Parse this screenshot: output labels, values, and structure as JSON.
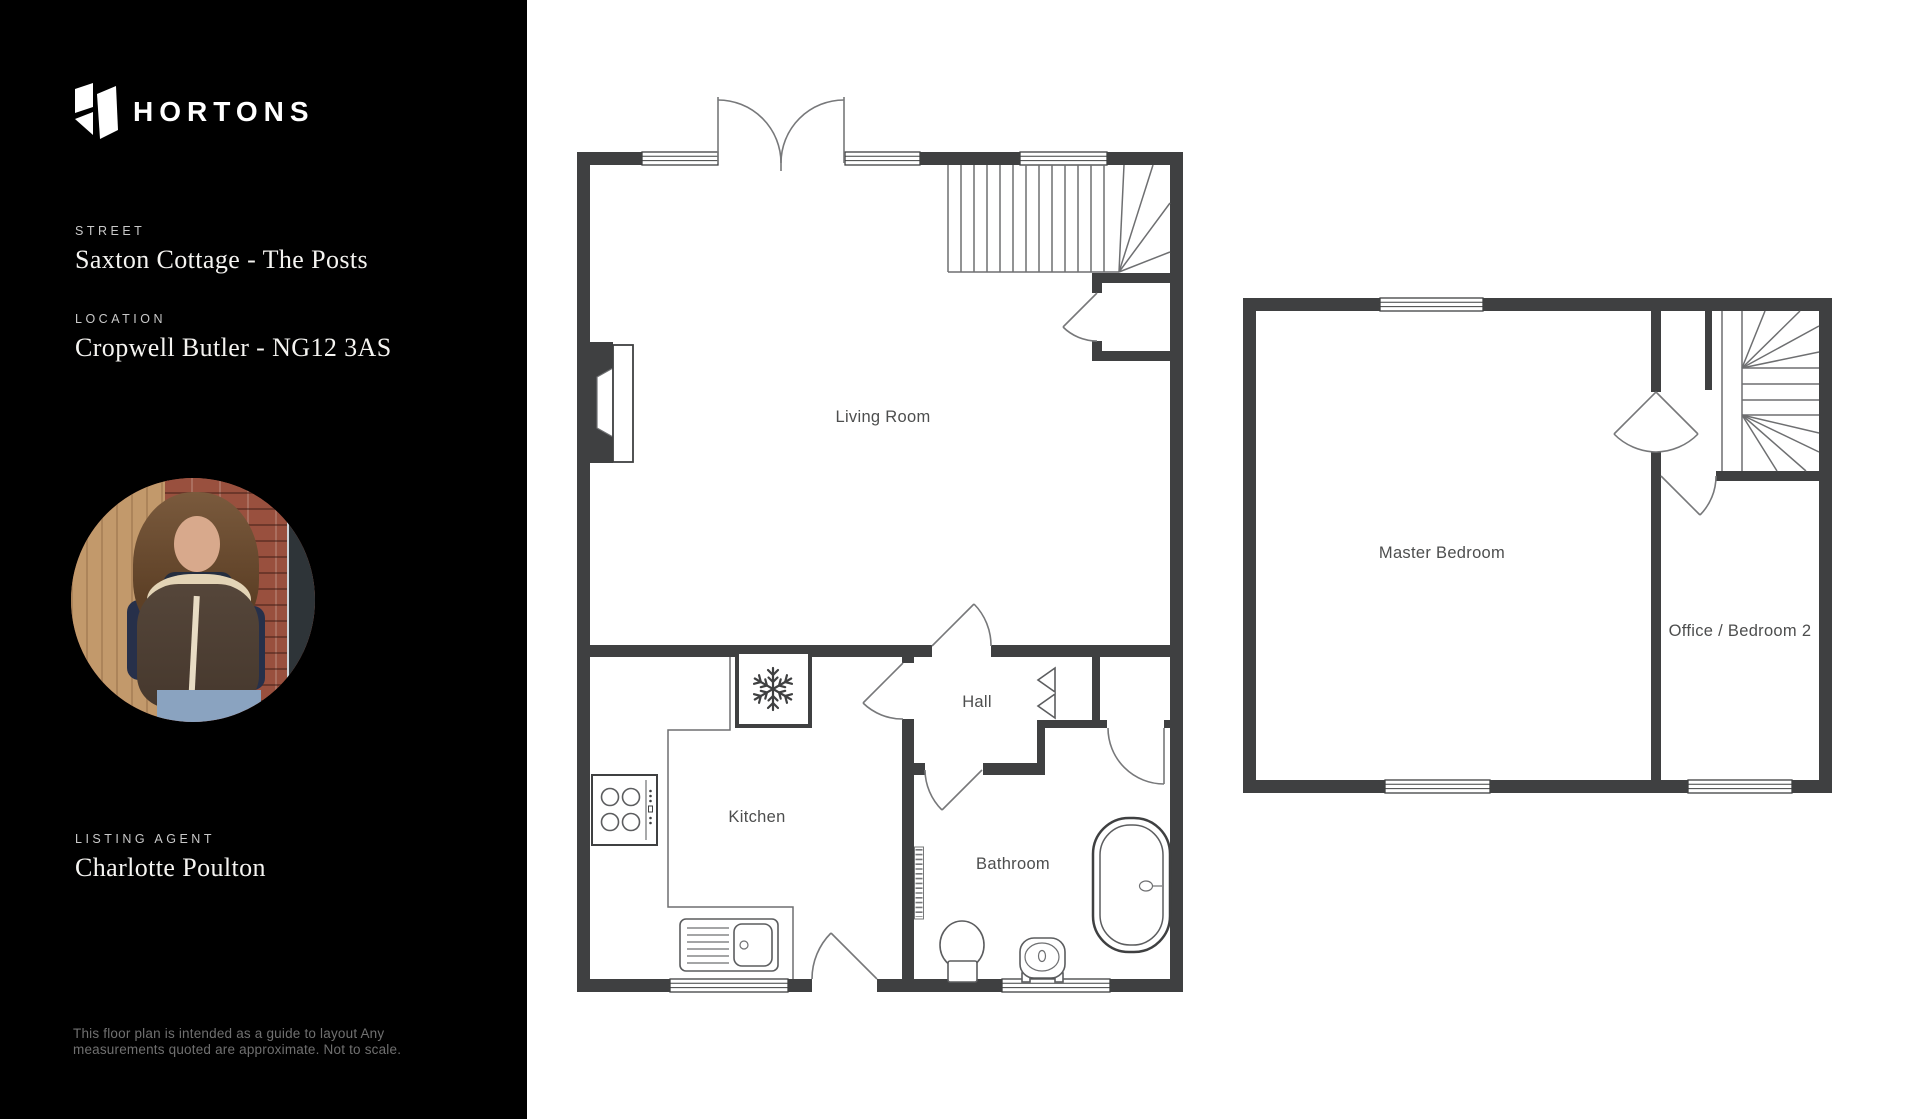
{
  "colors": {
    "sidebar_bg": "#000000",
    "wall": "#3f4041",
    "thin_line": "#6e6f71",
    "room_label": "#4d4e4e",
    "sidebar_heading": "#c9c9c9",
    "sidebar_text": "#f5f4f1",
    "disclaimer_text": "#707070"
  },
  "sidebar": {
    "brand": "HORTONS",
    "street": {
      "label": "STREET",
      "value": "Saxton Cottage - The Posts"
    },
    "location": {
      "label": "LOCATION",
      "value": "Cropwell Butler - NG12 3AS"
    },
    "agent": {
      "label": "LISTING AGENT",
      "value": "Charlotte Poulton"
    },
    "disclaimer": {
      "line1": "This floor plan is intended  as a guide to layout Any",
      "line2": "measurements quoted are approximate. Not to scale."
    }
  },
  "floorplans": {
    "ground": {
      "living_room": "Living Room",
      "kitchen": "Kitchen",
      "hall": "Hall",
      "bathroom": "Bathroom"
    },
    "first": {
      "master_bedroom": "Master Bedroom",
      "office": "Office / Bedroom 2"
    }
  },
  "icons": {
    "freezer_snowflake": "❄"
  }
}
